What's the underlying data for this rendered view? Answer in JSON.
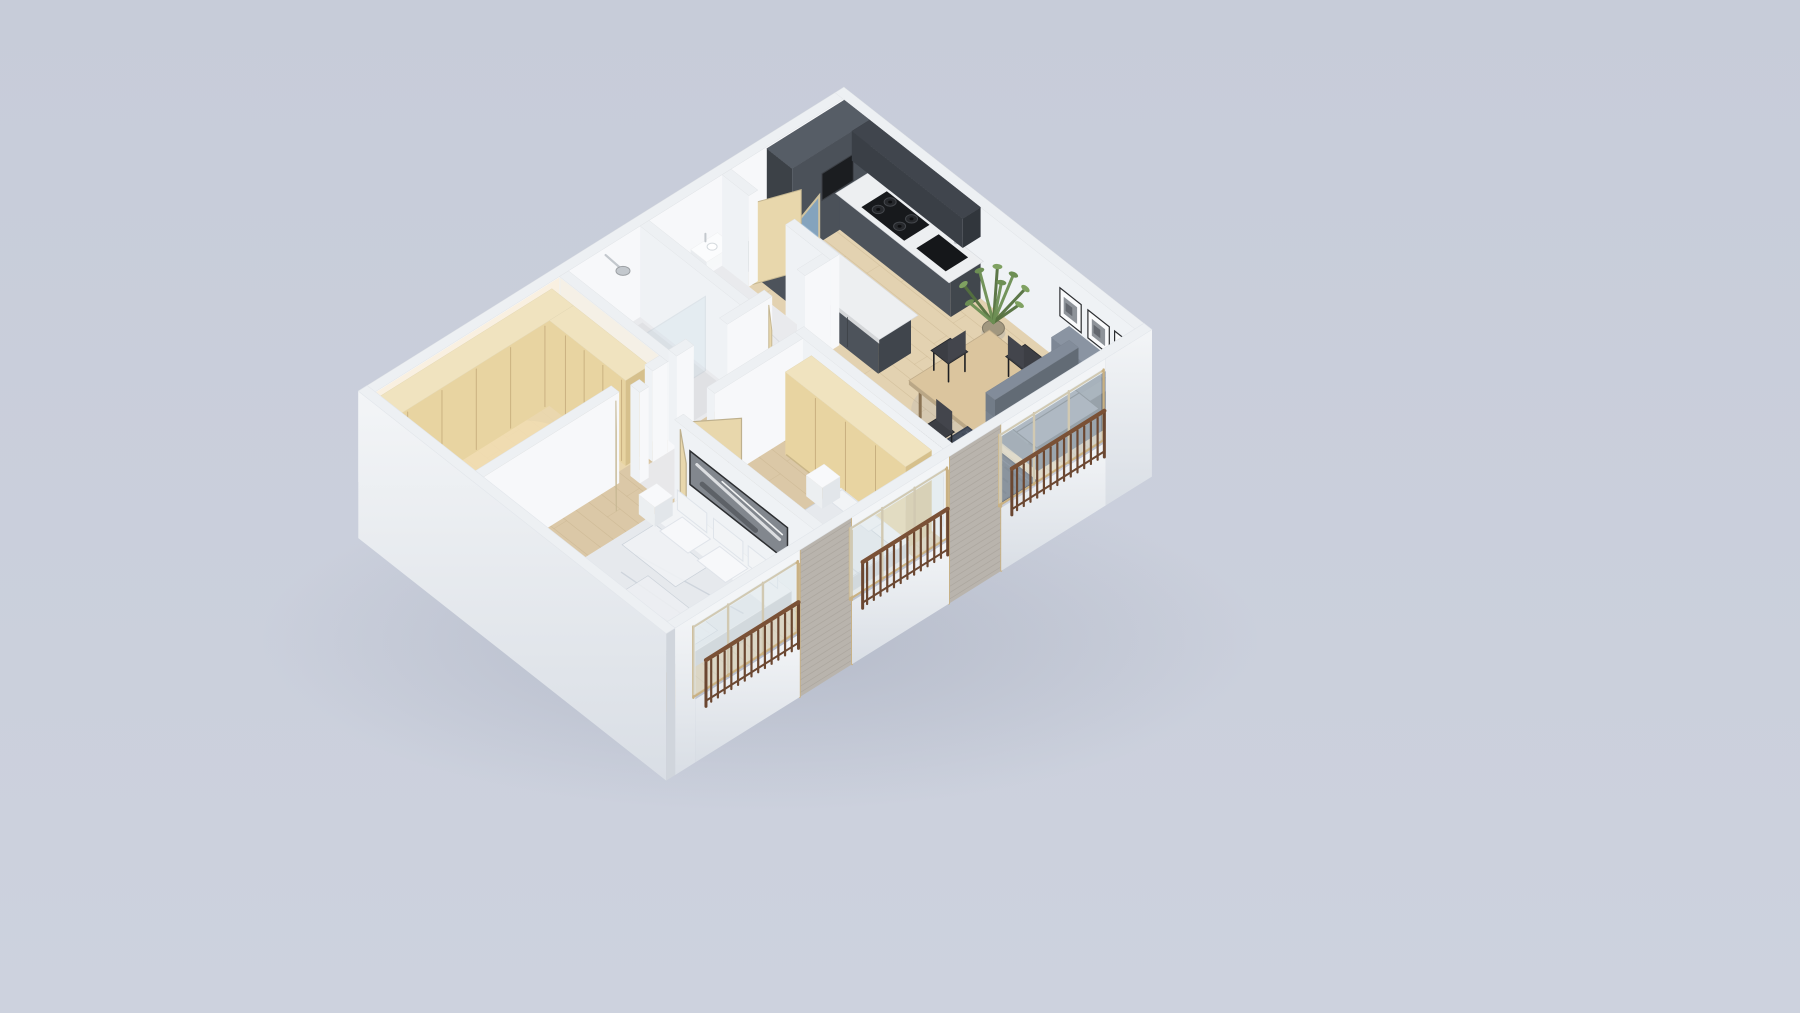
{
  "canvas": {
    "width": 1800,
    "height": 1013
  },
  "page": {
    "background_top": "#c7ccd9",
    "background_bottom": "#cdd2de"
  },
  "scene": {
    "type": "isometric-apartment-3d-floorplan-render",
    "palette": {
      "bgTop": "#c7ccd9",
      "bgBottom": "#cdd2de",
      "groundShadow": "#9aa1b2",
      "wallLit": "#f7f8fa",
      "wallMid": "#eff2f5",
      "wallShade": "#e4e8ee",
      "wallTop": "#edf0f3",
      "warmWall": "#f9eed8",
      "facade": "#f3f5f7",
      "facadeShade": "#d9dee5",
      "floorWood": "#dbc8a7",
      "floorWoodLight": "#e4d3b3",
      "floorWarm": "#ecd9af",
      "plankLine": "#c0ab85",
      "marble": "#e9eaed",
      "marbleVein": "#c6cad1",
      "kitchenDark": "#4d535b",
      "kitchenDarker": "#3a3f46",
      "counter": "#edeff1",
      "cooktop": "#17191c",
      "oven": "#1b1d20",
      "doorWood": "#e8d7ac",
      "doorGlassBlue": "#8fb2cf",
      "handleDark": "#2e2f32",
      "wardrobe": "#e8d4a1",
      "wardrobeSide": "#d6c08c",
      "wardrobeTop": "#f0e3bf",
      "seam": "#c3a97a",
      "tableWood": "#dbc59e",
      "chairDark": "#3c3e44",
      "sofa": "#78828f",
      "sofaDark": "#5f6877",
      "sofaLight": "#8a94a2",
      "rug": "#47505f",
      "rugDark": "#394150",
      "brass": "#b5a87e",
      "plantGreen": "#6d8f54",
      "plantGreenDark": "#55713f",
      "basket": "#a1977f",
      "bedWhite": "#f2f4f6",
      "bedShade": "#d9dde2",
      "duvet": "#e6e9ed",
      "foldLine": "#c9d0d8",
      "artGray": "#82878e",
      "frameDark": "#2c2e31",
      "artLight": "#f3f4f6",
      "yellowPillow": "#e5ce6b",
      "chrome": "#c3c8cd",
      "glass": "#cfe0ea",
      "windowGlass": "#dce6ec",
      "windowWood": "#c9b183",
      "brick": "#b9b4ad",
      "brickLine": "#a49e96",
      "railing": "#6b4731",
      "railingTop": "#7a5136"
    },
    "rooms": [
      {
        "name": "kitchen",
        "furniture": [
          "tall-cabinet-run",
          "base-cabinets",
          "upper-cabinets",
          "built-in-oven",
          "marble-countertop",
          "gas-cooktop",
          "black-sink",
          "faucet",
          "peninsula-island",
          "bathroom-door-blue-glass",
          "folding-wood-door"
        ]
      },
      {
        "name": "living-dining",
        "furniture": [
          "dining-table",
          "dining-chairs",
          "potted-plant",
          "sofa",
          "area-rug",
          "round-brass-coffee-table",
          "wall-picture-frames"
        ]
      },
      {
        "name": "wc",
        "furniture": [
          "wash-basin",
          "faucet"
        ]
      },
      {
        "name": "shower-room",
        "furniture": [
          "shower-head",
          "glass-screen",
          "marble-tray"
        ]
      },
      {
        "name": "closet-room",
        "furniture": [
          "built-in-wardrobes",
          "cove-lighting"
        ]
      },
      {
        "name": "hallway",
        "furniture": [
          "wc-door",
          "closet-door",
          "marble-floor"
        ]
      },
      {
        "name": "bedroom-2",
        "furniture": [
          "wardrobe",
          "single-bed",
          "white-pillows",
          "yellow-round-pillow",
          "side-table",
          "open-door"
        ]
      },
      {
        "name": "master-bedroom",
        "furniture": [
          "double-bed",
          "pillows",
          "duvet",
          "wall-art-panel",
          "bedside-table",
          "open-door"
        ]
      }
    ],
    "exterior": {
      "facade_window_groups": 3,
      "balcony_railings": 3,
      "brick_piers": 2,
      "railing_color": "#6b4731",
      "solid_white_facade_side": "south-west"
    }
  }
}
